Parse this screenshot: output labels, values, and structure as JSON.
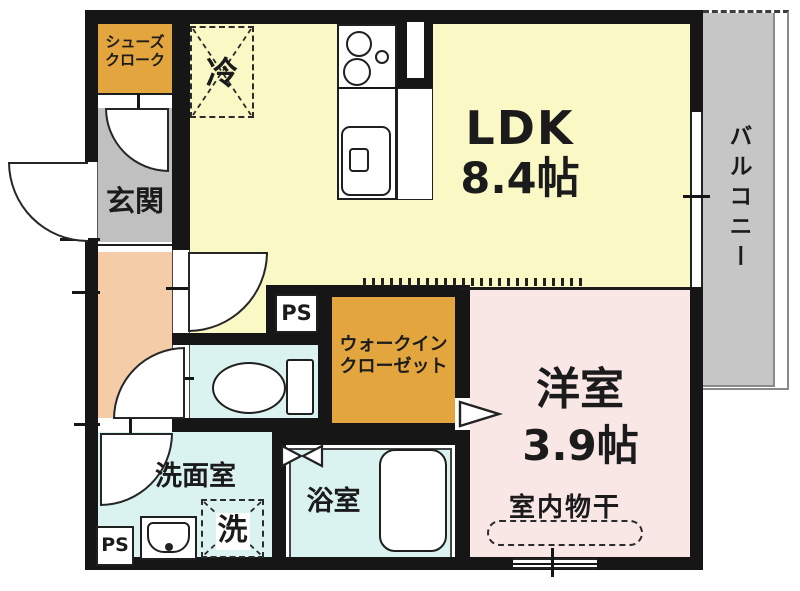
{
  "rooms": {
    "ldk": {
      "name": "LDK",
      "size": "8.4帖"
    },
    "western_room": {
      "name": "洋室",
      "size": "3.9帖"
    },
    "balcony": {
      "name": "バルコニー"
    },
    "entrance": {
      "name": "玄関"
    },
    "shoes_closet": {
      "line1": "シューズ",
      "line2": "クローク"
    },
    "walk_in_closet": {
      "line1": "ウォークイン",
      "line2": "クローゼット"
    },
    "washroom": {
      "name": "洗面室"
    },
    "bathroom": {
      "name": "浴室"
    }
  },
  "fixtures": {
    "refrigerator": "冷",
    "washing_machine": "洗",
    "indoor_drying": "室内物干",
    "pipe_space_upper": "PS",
    "pipe_space_lower": "PS"
  },
  "colors": {
    "ldk_yellow": "#FAF8C4",
    "closet_orange": "#E3A53D",
    "entrance_gray": "#C1C0C0",
    "hallway_salmon": "#F4CCA7",
    "wet_area_cyan": "#DAF2F0",
    "western_pink": "#F9E7E6",
    "balcony_gray": "#C6C6C6",
    "wall_black": "#161616"
  }
}
